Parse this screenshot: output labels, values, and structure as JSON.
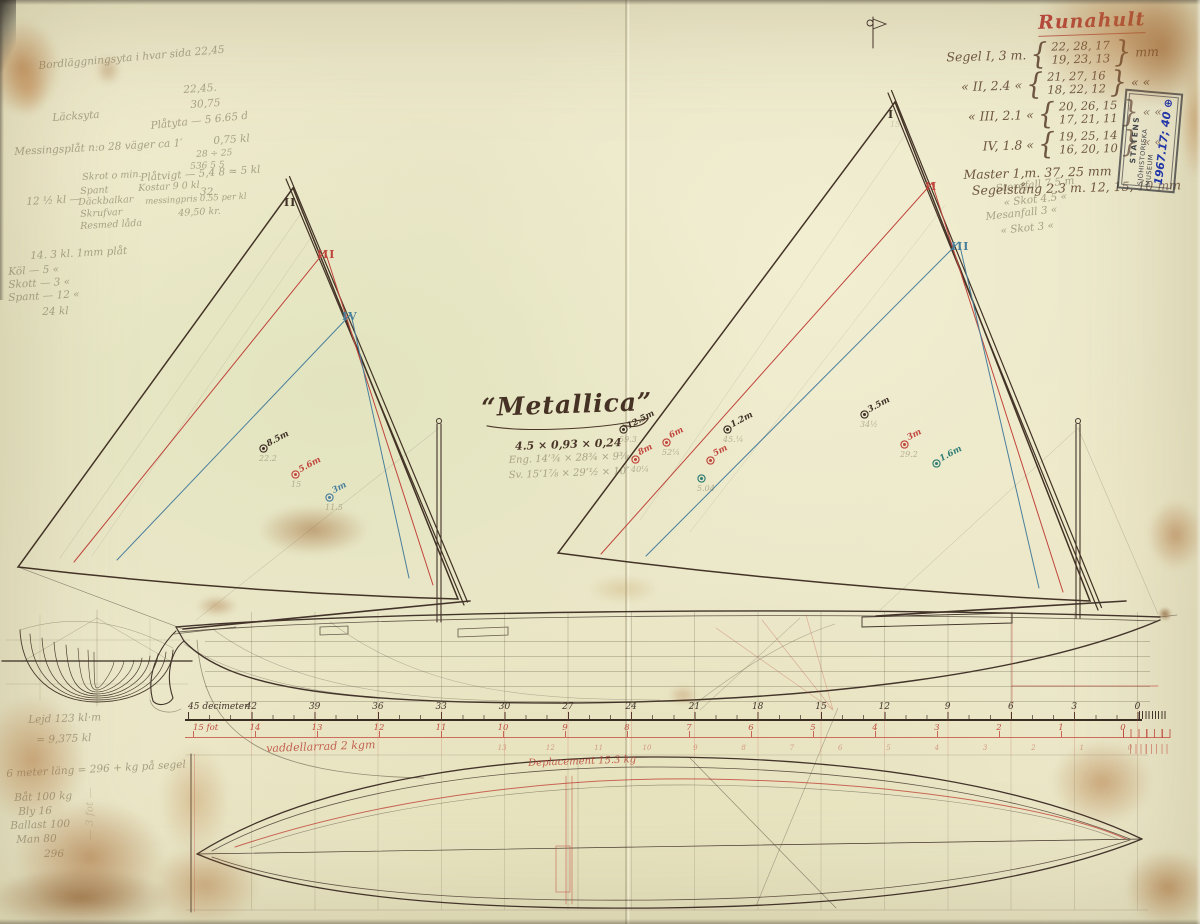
{
  "palette": {
    "ink": "#3f3026",
    "red": "#c0453c",
    "blue": "#4a7f9c",
    "teal": "#2f7d74",
    "paper": "#ebe7c9",
    "red_ink": "#b5473c",
    "stamp_blue": "#2336a8"
  },
  "document": {
    "red_title": "Runahult",
    "boat_name": "“Metallica”",
    "ink_dims": "4.5 × 0,93 × 0,24",
    "pencil_dim_1": "Eng. 14’¾ × 28¾ × 9⅜",
    "pencil_dim_2": "Sv. 15’1⅞ × 29’½ × 10″"
  },
  "stamp": {
    "line1": "STATENS",
    "line2": "SJÖHISTORISKA MUSEUM",
    "number": "1967.17; 40 ⊕"
  },
  "sail_table": {
    "rows": [
      {
        "label": "Segel I, 3 m.",
        "top": "22, 28, 17",
        "bottom": "19, 23, 13",
        "unit": "mm"
      },
      {
        "label": "«  II, 2.4 «",
        "top": "21, 27, 16",
        "bottom": "18, 22, 12",
        "unit": "« «"
      },
      {
        "label": "«  III, 2.1 «",
        "top": "20, 26, 15",
        "bottom": "17, 21, 11",
        "unit": "« «"
      },
      {
        "label": "IV, 1.8 «",
        "top": "19, 25, 14",
        "bottom": "16, 20, 10",
        "unit": "« «"
      }
    ],
    "mast_line": "Master 1,m. 37, 25 mm",
    "spar_line": "Segelstång 2.3 m. 12, 15, 10 mm"
  },
  "ruler": {
    "dm_values": [
      45,
      42,
      39,
      36,
      33,
      30,
      27,
      24,
      21,
      18,
      15,
      12,
      9,
      6,
      3,
      0
    ],
    "dm_unit": "decimeter",
    "fot_values": [
      15,
      14,
      13,
      12,
      11,
      10,
      9,
      8,
      7,
      6,
      5,
      4,
      3,
      2,
      1,
      0
    ],
    "fot_unit": "fot",
    "fot2_values": [
      13,
      12,
      11,
      10,
      9,
      8,
      7,
      6,
      5,
      4,
      3,
      2,
      1,
      0
    ]
  },
  "sail_plan": {
    "labels": [
      {
        "t": "II",
        "x": 284,
        "y": 196,
        "c": "ink"
      },
      {
        "t": "III",
        "x": 317,
        "y": 248,
        "c": "red"
      },
      {
        "t": "IV",
        "x": 342,
        "y": 310,
        "c": "blue"
      },
      {
        "t": "I",
        "x": 888,
        "y": 108,
        "c": "ink"
      },
      {
        "t": "II",
        "x": 925,
        "y": 180,
        "c": "red"
      },
      {
        "t": "III",
        "x": 951,
        "y": 240,
        "c": "blue"
      }
    ],
    "area_markers": [
      {
        "x": 262,
        "y": 447,
        "c": "ink",
        "l": "8.5m",
        "s": "22.2"
      },
      {
        "x": 294,
        "y": 473,
        "c": "red",
        "l": "5.6m",
        "s": "15"
      },
      {
        "x": 328,
        "y": 496,
        "c": "blue",
        "l": "3m",
        "s": "11.5"
      },
      {
        "x": 622,
        "y": 428,
        "c": "ink",
        "l": "12.5m",
        "s": "59.3"
      },
      {
        "x": 665,
        "y": 441,
        "c": "red",
        "l": "6m",
        "s": "52¼"
      },
      {
        "x": 634,
        "y": 458,
        "c": "red",
        "l": "8m",
        "s": "40¼"
      },
      {
        "x": 709,
        "y": 459,
        "c": "red",
        "l": "5m",
        "s": ""
      },
      {
        "x": 700,
        "y": 477,
        "c": "teal",
        "l": "",
        "s": "5.04"
      },
      {
        "x": 726,
        "y": 428,
        "c": "ink",
        "l": "1.2m",
        "s": "45.¼"
      },
      {
        "x": 863,
        "y": 413,
        "c": "ink",
        "l": "3.5m",
        "s": "34½"
      },
      {
        "x": 903,
        "y": 443,
        "c": "red",
        "l": "3m",
        "s": "29.2"
      },
      {
        "x": 935,
        "y": 462,
        "c": "teal",
        "l": "1.6m",
        "s": ""
      }
    ]
  },
  "pencil_notes": [
    {
      "t": "Bordläggningsyta i hvar sida 22,45",
      "x": 38,
      "y": 60,
      "r": -5
    },
    {
      "t": "22,45.",
      "x": 183,
      "y": 84,
      "r": -4
    },
    {
      "t": "Läcksyta",
      "x": 52,
      "y": 112,
      "r": -4
    },
    {
      "t": "30,75",
      "x": 190,
      "y": 99,
      "r": -4
    },
    {
      "t": "Plåtyta — 5 6.65 d",
      "x": 150,
      "y": 120,
      "r": -6
    },
    {
      "t": "0,75 kl",
      "x": 213,
      "y": 135,
      "r": -4
    },
    {
      "t": "Messingsplåt n:o 28 väger ca 1′",
      "x": 14,
      "y": 146,
      "r": -3
    },
    {
      "t": "28 ÷ 25",
      "x": 196,
      "y": 150,
      "r": -3,
      "s": 9
    },
    {
      "t": "536 5 5",
      "x": 190,
      "y": 162,
      "r": -3,
      "s": 9
    },
    {
      "t": "Plåtvigt — 5,4 8 ≈ 5 kl",
      "x": 140,
      "y": 172,
      "r": -4
    },
    {
      "t": "32.",
      "x": 200,
      "y": 186,
      "r": 0
    },
    {
      "t": "12 ½ kl —",
      "x": 26,
      "y": 196,
      "r": -3
    },
    {
      "t": "Skrot o min.",
      "x": 82,
      "y": 172,
      "r": -3,
      "s": 9.5
    },
    {
      "t": "Spant",
      "x": 80,
      "y": 186,
      "r": -3,
      "s": 9.5
    },
    {
      "t": "Däckbalkar",
      "x": 78,
      "y": 197,
      "r": -3,
      "s": 9.5
    },
    {
      "t": "Skrufvar",
      "x": 80,
      "y": 209,
      "r": -3,
      "s": 9.5
    },
    {
      "t": "Resmed låda",
      "x": 80,
      "y": 221,
      "r": -3,
      "s": 9.5
    },
    {
      "t": "Kostar 9 0 kl",
      "x": 138,
      "y": 183,
      "r": -3,
      "s": 9.5
    },
    {
      "t": "messingpris 0.55 per kl",
      "x": 145,
      "y": 197,
      "r": -3,
      "s": 8.5
    },
    {
      "t": "49,50 kr.",
      "x": 178,
      "y": 208,
      "r": -3,
      "s": 9.5
    },
    {
      "t": "14. 3 kl. 1mm plåt",
      "x": 30,
      "y": 250,
      "r": -3
    },
    {
      "t": "Köl — 5 «",
      "x": 8,
      "y": 266,
      "r": -3
    },
    {
      "t": "Skott — 3 «",
      "x": 8,
      "y": 279,
      "r": -3
    },
    {
      "t": "Spant — 12 «",
      "x": 8,
      "y": 292,
      "r": -3
    },
    {
      "t": "24 kl",
      "x": 42,
      "y": 306,
      "r": -2
    },
    {
      "t": "Storefall 7.5 m",
      "x": 995,
      "y": 183,
      "r": -6
    },
    {
      "t": "«  Skot 4.5 «",
      "x": 1003,
      "y": 197,
      "r": -6
    },
    {
      "t": "Mesanfall 3  «",
      "x": 985,
      "y": 211,
      "r": -6
    },
    {
      "t": "«  Skot 3 «",
      "x": 1000,
      "y": 225,
      "r": -6
    },
    {
      "t": "15",
      "x": 890,
      "y": 120,
      "s": 8,
      "c": "faint"
    },
    {
      "t": "Lejd 123 kl·m",
      "x": 28,
      "y": 714,
      "r": -2
    },
    {
      "t": "= 9,375 kl",
      "x": 36,
      "y": 734,
      "r": -2
    },
    {
      "t": "6 meter läng = 296 + kg på segel",
      "x": 6,
      "y": 768,
      "r": -3
    },
    {
      "t": "Båt  100 kg",
      "x": 14,
      "y": 792,
      "r": -2
    },
    {
      "t": "Bly    16",
      "x": 18,
      "y": 806,
      "r": -2
    },
    {
      "t": "Ballast 100",
      "x": 10,
      "y": 820,
      "r": -2
    },
    {
      "t": "Man    80",
      "x": 16,
      "y": 834,
      "r": -2
    },
    {
      "t": "296",
      "x": 44,
      "y": 848,
      "r": 0
    },
    {
      "t": "— 3 fot —",
      "x": 84,
      "y": 840,
      "r": -90,
      "c": "faint"
    },
    {
      "t": "vaddellarrad 2 kgm",
      "x": 266,
      "y": 742,
      "r": -2,
      "c": "red",
      "s": 11
    },
    {
      "t": "Deplacement 15.3 kg",
      "x": 528,
      "y": 758,
      "r": -2,
      "c": "red",
      "s": 10
    }
  ]
}
